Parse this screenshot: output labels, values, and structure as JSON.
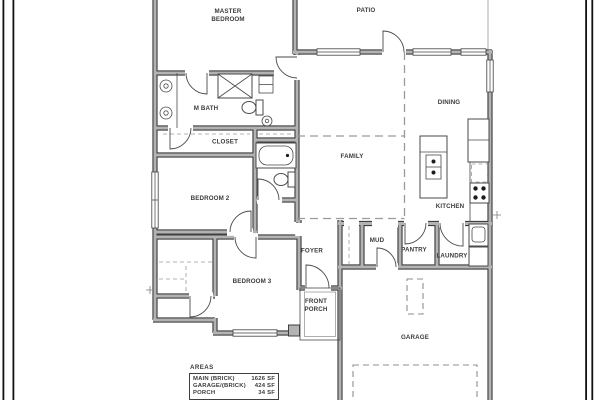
{
  "drawing": {
    "title": "residential floor plan",
    "labels": {
      "master_bedroom_1": "MASTER",
      "master_bedroom_2": "BEDROOM",
      "patio": "PATIO",
      "dining": "DINING",
      "family": "FAMILY",
      "kitchen": "KITCHEN",
      "m_bath": "M BATH",
      "closet": "CLOSET",
      "bedroom_2": "BEDROOM 2",
      "bedroom_3": "BEDROOM 3",
      "foyer": "FOYER",
      "mud": "MUD",
      "pantry": "PANTRY",
      "laundry": "LAUNDRY",
      "front_porch_1": "FRONT",
      "front_porch_2": "PORCH",
      "garage": "GARAGE"
    },
    "areas_table": {
      "title": "AREAS",
      "rows": [
        {
          "label": "MAIN (BRICK)",
          "value": "1626 SF"
        },
        {
          "label": "GARAGE/(BRICK)",
          "value": "424 SF"
        },
        {
          "label": "PORCH",
          "value": "34 SF"
        }
      ]
    },
    "colors": {
      "background": "#ffffff",
      "wall_edge": "#3f3f3f",
      "wall_fill": "#b3b3b3",
      "line": "#4a4a4a",
      "dash": "#9a9a9a",
      "text": "#3b3b3b"
    }
  }
}
